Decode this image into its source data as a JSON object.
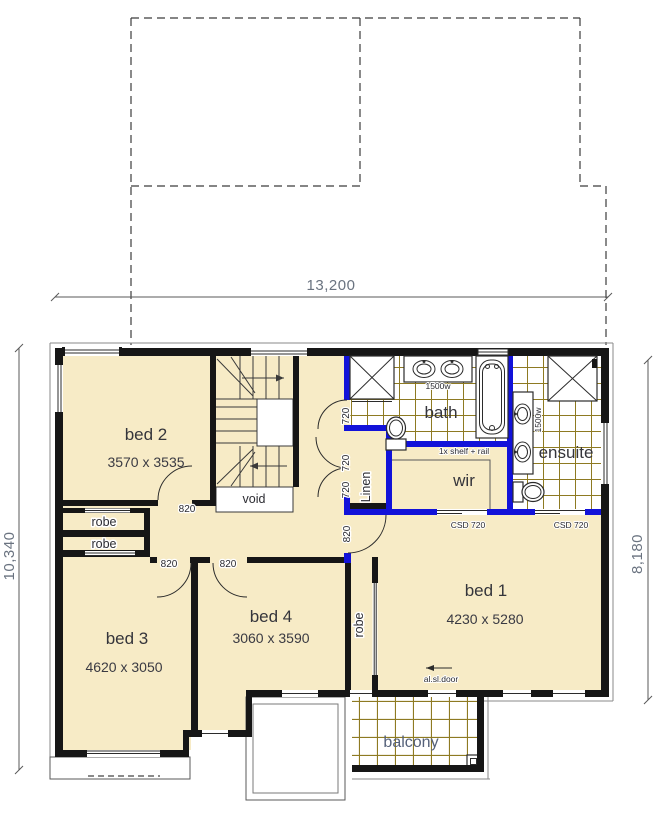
{
  "dimensions": {
    "top": "13,200",
    "left": "10,340",
    "right": "8,180"
  },
  "rooms": {
    "bed1": {
      "name": "bed 1",
      "size": "4230 x 5280"
    },
    "bed2": {
      "name": "bed 2",
      "size": "3570 x 3535"
    },
    "bed3": {
      "name": "bed 3",
      "size": "4620 x 3050"
    },
    "bed4": {
      "name": "bed 4",
      "size": "3060 x 3590"
    },
    "bath": {
      "name": "bath"
    },
    "ensuite": {
      "name": "ensuite"
    },
    "wir": {
      "name": "wir"
    },
    "linen": {
      "name": "Linen"
    },
    "void": {
      "name": "void"
    },
    "balcony": {
      "name": "balcony"
    },
    "robe": {
      "name": "robe"
    }
  },
  "annotations": {
    "door_820": "820",
    "door_720": "720",
    "cavity_door": "CSD 720",
    "vanity_width": "1500w",
    "shelf_rail": "1x shelf + rail",
    "sliding_door": "al.sl.door"
  },
  "colors": {
    "floor_cream": "#f7ebc6",
    "wet_wall_blue": "#1212d9",
    "tile_line_olive": "#8e7a22",
    "wall_black": "#161616",
    "dimension_text": "#6a7380"
  }
}
